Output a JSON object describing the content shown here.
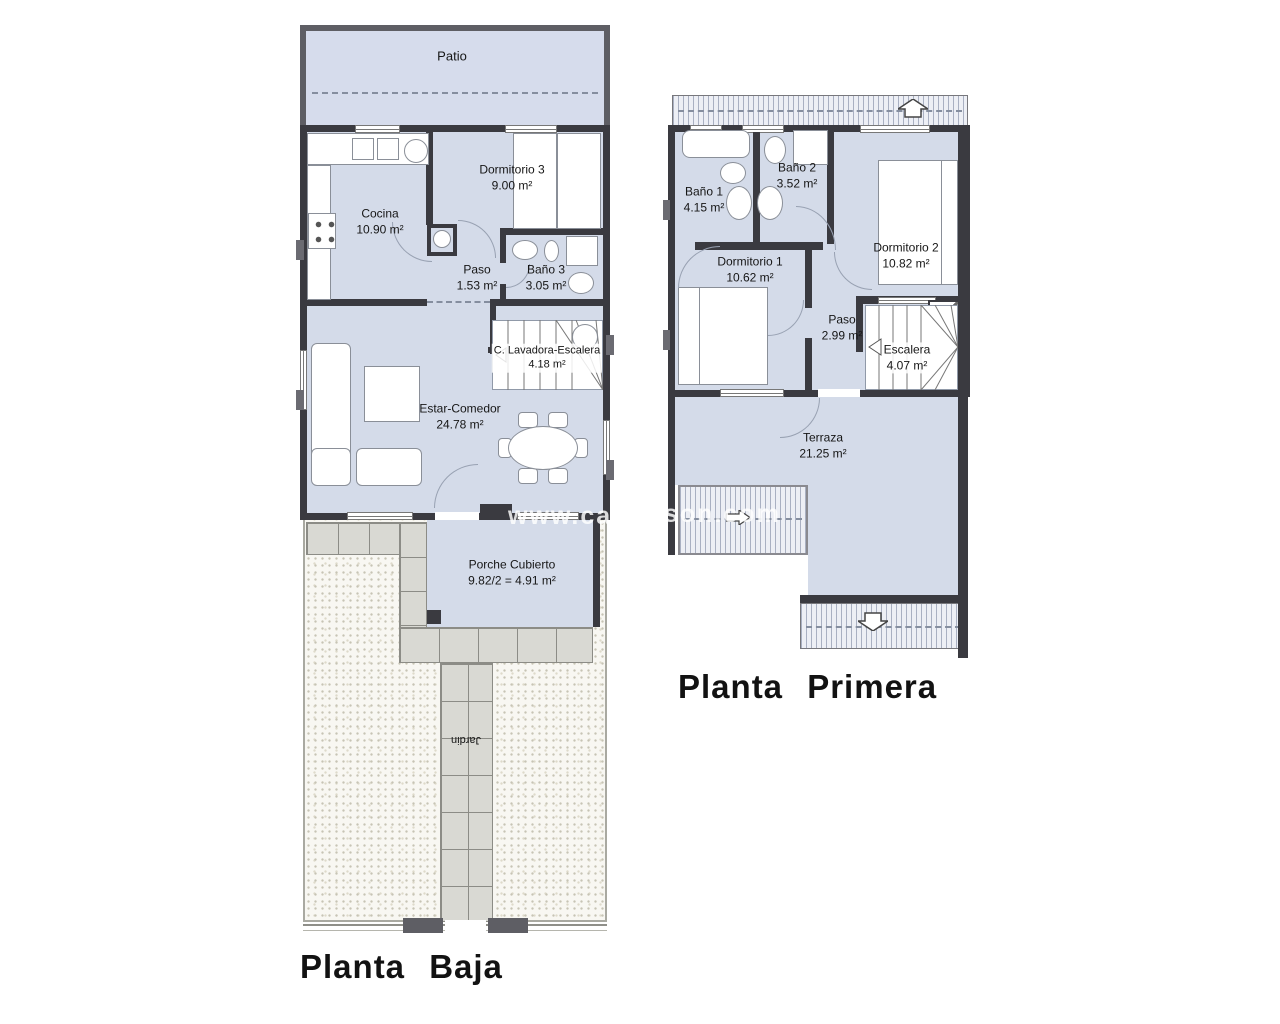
{
  "watermark": {
    "left": "www.cas",
    "right": "son.com"
  },
  "plans": {
    "planta_baja": {
      "title": "Planta Baja",
      "rooms": [
        {
          "name": "Patio",
          "area": ""
        },
        {
          "name": "Cocina",
          "area": "10.90 m²"
        },
        {
          "name": "Dormitorio 3",
          "area": "9.00 m²"
        },
        {
          "name": "Paso",
          "area": "1.53 m²"
        },
        {
          "name": "Baño 3",
          "area": "3.05 m²"
        },
        {
          "name": "C. Lavadora-Escalera",
          "area": "4.18 m²"
        },
        {
          "name": "Estar-Comedor",
          "area": "24.78 m²"
        },
        {
          "name": "Porche Cubierto",
          "area": "9.82/2 = 4.91 m²"
        },
        {
          "name": "Jardin",
          "area": ""
        }
      ]
    },
    "planta_primera": {
      "title": "Planta Primera",
      "rooms": [
        {
          "name": "Baño 1",
          "area": "4.15 m²"
        },
        {
          "name": "Baño 2",
          "area": "3.52 m²"
        },
        {
          "name": "Dormitorio 1",
          "area": "10.62 m²"
        },
        {
          "name": "Dormitorio 2",
          "area": "10.82 m²"
        },
        {
          "name": "Paso",
          "area": "2.99 m²"
        },
        {
          "name": "Escalera",
          "area": "4.07 m²"
        },
        {
          "name": "Terraza",
          "area": "21.25 m²"
        }
      ]
    }
  },
  "colors": {
    "room_fill": "#d4dbe9",
    "patio_fill": "#d6dcec",
    "wall": "#3a3a40",
    "patio_wall": "#5e5e64",
    "tile_fill": "#d9d9d3",
    "tile_line": "#8c8c86",
    "jardin_bg": "#f8f7f2",
    "hatch_bg": "#edeff5",
    "hatch_line": "#a9b0c2",
    "watermark_color": "rgba(255,255,255,0.82)"
  }
}
